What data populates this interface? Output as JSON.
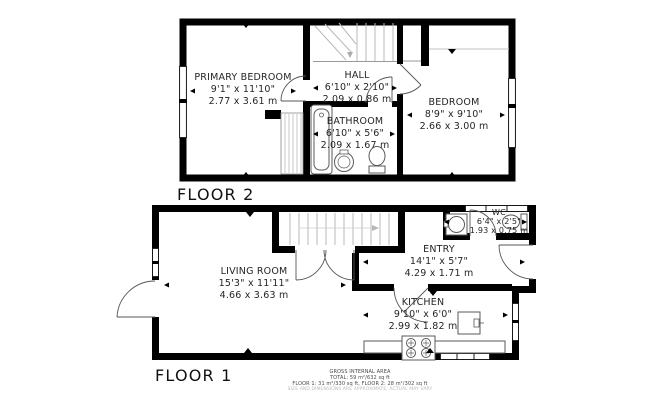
{
  "plan": {
    "floor2": {
      "label": "FLOOR 2",
      "rooms": {
        "primary_bedroom": {
          "name": "PRIMARY BEDROOM",
          "imperial": "9'1\" x 11'10\"",
          "metric": "2.77 x 3.61 m"
        },
        "hall": {
          "name": "HALL",
          "imperial": "6'10\" x 2'10\"",
          "metric": "2.09 x 0.86 m"
        },
        "bathroom": {
          "name": "BATHROOM",
          "imperial": "6'10\" x 5'6\"",
          "metric": "2.09 x 1.67 m"
        },
        "bedroom": {
          "name": "BEDROOM",
          "imperial": "8'9\" x 9'10\"",
          "metric": "2.66 x 3.00 m"
        }
      }
    },
    "floor1": {
      "label": "FLOOR 1",
      "rooms": {
        "living_room": {
          "name": "LIVING ROOM",
          "imperial": "15'3\" x 11'11\"",
          "metric": "4.66 x 3.63 m"
        },
        "wc": {
          "name": "WC",
          "imperial": "6'4\" x 2'5\"",
          "metric": "1.93 x 0.75 m"
        },
        "entry": {
          "name": "ENTRY",
          "imperial": "14'1\" x 5'7\"",
          "metric": "4.29 x 1.71 m"
        },
        "kitchen": {
          "name": "KITCHEN",
          "imperial": "9'10\" x 6'0\"",
          "metric": "2.99 x 1.82 m"
        }
      }
    },
    "footer": {
      "line1": "GROSS INTERNAL AREA",
      "line2": "TOTAL: 59 m²/632 sq ft",
      "line3": "FLOOR 1: 31 m²/330 sq ft, FLOOR 2: 28 m²/302 sq ft",
      "line4": "SIZE AND DIMENSIONS ARE APPROXIMATE, ACTUAL MAY VARY"
    }
  }
}
